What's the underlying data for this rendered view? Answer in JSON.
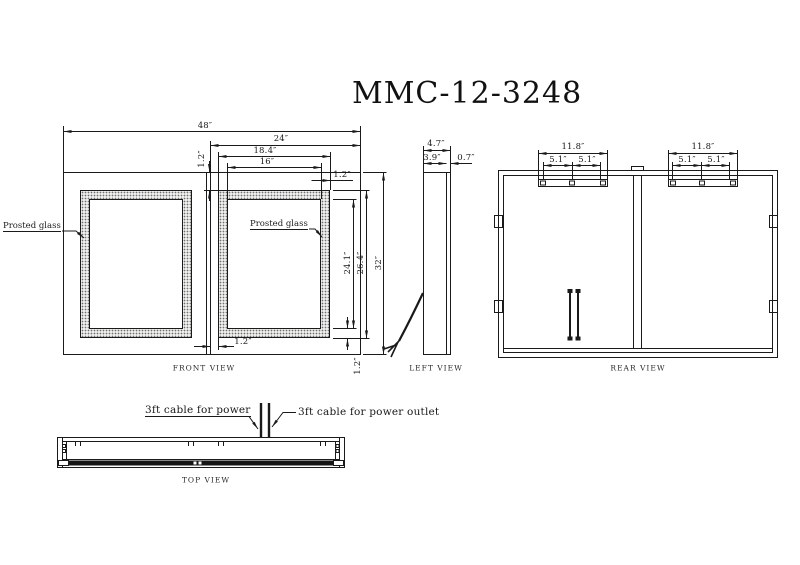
{
  "title": "MMC-12-3248",
  "front_view": {
    "label": "FRONT VIEW",
    "glass_note": "Prosted glass",
    "dims": {
      "overall_width": "48″",
      "half_width": "24″",
      "frame_width": "18.4″",
      "glass_width": "16″",
      "edge_offset": "1.2″",
      "glass_height": "24.1″",
      "frame_height": "26.4″",
      "overall_height": "32″"
    }
  },
  "left_view": {
    "label": "LEFT VIEW",
    "dims": {
      "overall_depth": "4.7″",
      "body_depth": "3.9″",
      "mirror_depth": "0.7″"
    }
  },
  "rear_view": {
    "label": "REAR VIEW",
    "dims": {
      "bracket_width": "11.8″",
      "bracket_half": "5.1″"
    }
  },
  "top_view": {
    "label": "TOP VIEW",
    "cable_power": "3ft cable for power",
    "cable_outlet": "3ft cable for power outlet"
  }
}
